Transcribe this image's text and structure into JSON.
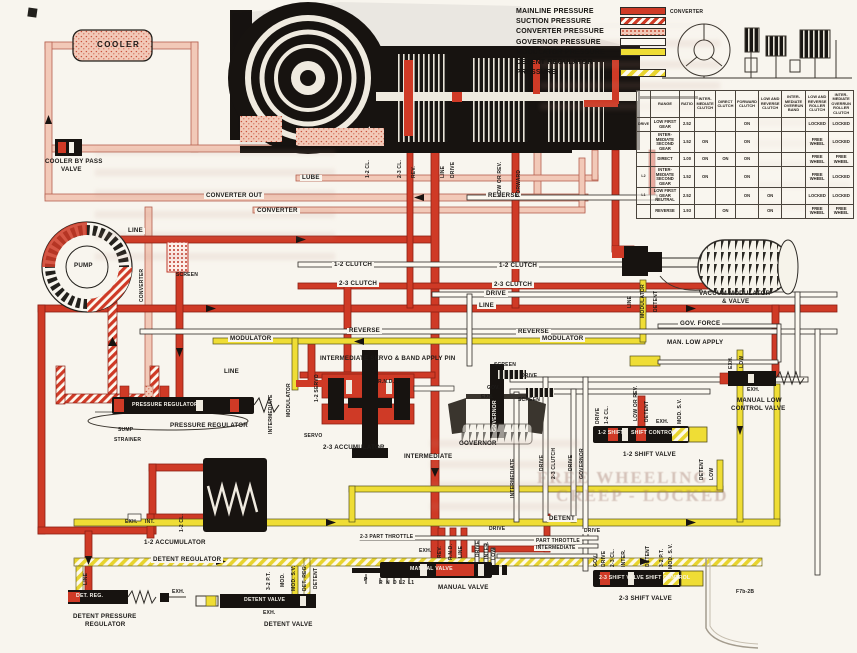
{
  "legend": {
    "items": [
      {
        "label": "MAINLINE PRESSURE",
        "swatch": "solid-red"
      },
      {
        "label": "SUCTION PRESSURE",
        "swatch": "hatch-red"
      },
      {
        "label": "CONVERTER PRESSURE",
        "swatch": "stipple-pink"
      },
      {
        "label": "GOVERNOR PRESSURE",
        "swatch": "white"
      },
      {
        "label": "MODULATOR PRESSURE",
        "swatch": "solid-yellow"
      },
      {
        "label": "DETENT REGULATOR",
        "swatch": "none"
      },
      {
        "label": "PRESSURE",
        "swatch": "hatch-yellow"
      }
    ]
  },
  "colors": {
    "mainline": "#cf3a26",
    "suction": "#cf3a26",
    "converter": "#f2c9b8",
    "governor": "#fcf9f1",
    "modulator": "#efdd35",
    "detent": "#e8d42e",
    "paper": "#f8f5ee"
  },
  "clutch_table": {
    "headers": [
      "",
      "RANGE",
      "RATIO",
      "INTER-MEDIATE CLUTCH",
      "DIRECT CLUTCH",
      "FORWARD CLUTCH",
      "LOW AND REVERSE CLUTCH",
      "INTER-MEDIATE OVERRUN BAND",
      "LOW AND REVERSE ROLLER CLUTCH",
      "INTER-MEDIATE OVERRUN ROLLER CLUTCH"
    ],
    "rows": [
      [
        "DRIVE",
        "LOW FIRST GEAR",
        "2.52",
        "",
        "",
        "ON",
        "",
        "",
        "LOCKED",
        "LOCKED"
      ],
      [
        "",
        "INTER-MEDIATE SECOND GEAR",
        "1.52",
        "ON",
        "",
        "ON",
        "",
        "",
        "FREE WHEEL",
        "LOCKED"
      ],
      [
        "",
        "DIRECT",
        "1.00",
        "ON",
        "ON",
        "ON",
        "",
        "",
        "FREE WHEEL",
        "FREE WHEEL"
      ],
      [
        "L2",
        "INTER-MEDIATE SECOND GEAR",
        "1.52",
        "ON",
        "",
        "ON",
        "",
        "",
        "FREE WHEEL",
        "LOCKED"
      ],
      [
        "L1",
        "LOW FIRST GEAR NEUTRAL",
        "2.52",
        "",
        "",
        "ON",
        "ON",
        "",
        "LOCKED",
        "LOCKED"
      ],
      [
        "",
        "REVERSE",
        "1.93",
        "",
        "ON",
        "",
        "ON",
        "",
        "FREE WHEEL",
        "FREE WHEEL"
      ]
    ]
  },
  "diagram": {
    "fig_number": "F7b-2B",
    "mini_schematic_label": "CONVERTER",
    "ghosts": [
      {
        "t": "FREE WHEELING",
        "x": 537,
        "y": 468,
        "s": 17
      },
      {
        "t": "CREEP - LOCKED",
        "x": 556,
        "y": 486,
        "s": 17
      }
    ],
    "labels": [
      {
        "t": "COOLER",
        "x": 97,
        "y": 41,
        "c": "b7"
      },
      {
        "t": "COOLER BY PASS",
        "x": 45,
        "y": 159
      },
      {
        "t": "VALVE",
        "x": 61,
        "y": 167
      },
      {
        "t": "CONVERTER OUT",
        "x": 204,
        "y": 193,
        "c": "in"
      },
      {
        "t": "CONVERTER",
        "x": 255,
        "y": 208,
        "c": "in"
      },
      {
        "t": "LUBE",
        "x": 300,
        "y": 175,
        "c": "in"
      },
      {
        "t": "REVERSE",
        "x": 486,
        "y": 193,
        "c": "in"
      },
      {
        "t": "LINE",
        "x": 126,
        "y": 228,
        "c": "in"
      },
      {
        "t": "SCREEN",
        "x": 176,
        "y": 273,
        "c": "b5"
      },
      {
        "t": "PUMP",
        "x": 74,
        "y": 263
      },
      {
        "t": "CONVERTER",
        "x": 140,
        "y": 302,
        "r": 1,
        "c": "b5"
      },
      {
        "t": "1-2 CL.",
        "x": 366,
        "y": 178,
        "r": 1,
        "c": "b5"
      },
      {
        "t": "2-3 CL.",
        "x": 398,
        "y": 178,
        "r": 1,
        "c": "b5"
      },
      {
        "t": "REV.",
        "x": 412,
        "y": 178,
        "r": 1,
        "c": "b5"
      },
      {
        "t": "LINE",
        "x": 441,
        "y": 178,
        "r": 1,
        "c": "b5"
      },
      {
        "t": "DRIVE",
        "x": 451,
        "y": 178,
        "r": 1,
        "c": "b5"
      },
      {
        "t": "LOW OR REV.",
        "x": 498,
        "y": 197,
        "r": 1,
        "c": "b5"
      },
      {
        "t": "FORWARD",
        "x": 517,
        "y": 197,
        "r": 1,
        "c": "b5"
      },
      {
        "t": "1-2 CLUTCH",
        "x": 332,
        "y": 262,
        "c": "in"
      },
      {
        "t": "1-2 CLUTCH",
        "x": 497,
        "y": 263,
        "c": "in"
      },
      {
        "t": "2-3 CLUTCH",
        "x": 337,
        "y": 281,
        "c": "in"
      },
      {
        "t": "2-3 CLUTCH",
        "x": 492,
        "y": 282,
        "c": "in"
      },
      {
        "t": "DRIVE",
        "x": 484,
        "y": 291,
        "c": "in"
      },
      {
        "t": "LINE",
        "x": 477,
        "y": 303,
        "c": "in"
      },
      {
        "t": "REVERSE",
        "x": 347,
        "y": 328,
        "c": "in"
      },
      {
        "t": "REVERSE",
        "x": 516,
        "y": 329,
        "c": "in"
      },
      {
        "t": "MODULATOR",
        "x": 540,
        "y": 336,
        "c": "in"
      },
      {
        "t": "MODULATOR",
        "x": 228,
        "y": 336,
        "c": "in"
      },
      {
        "t": "VACUUM MODULATOR",
        "x": 699,
        "y": 291
      },
      {
        "t": "& VALVE",
        "x": 722,
        "y": 299
      },
      {
        "t": "LINE",
        "x": 628,
        "y": 308,
        "r": 1,
        "c": "b5"
      },
      {
        "t": "MODULATOR",
        "x": 641,
        "y": 318,
        "r": 1,
        "c": "b5"
      },
      {
        "t": "DETENT",
        "x": 654,
        "y": 312,
        "r": 1,
        "c": "b5"
      },
      {
        "t": "GOV. FORCE",
        "x": 678,
        "y": 321,
        "c": "in"
      },
      {
        "t": "MAN. LOW APPLY",
        "x": 665,
        "y": 340,
        "c": "in"
      },
      {
        "t": "EXH.",
        "x": 729,
        "y": 369,
        "r": 1,
        "c": "b5"
      },
      {
        "t": "LOW",
        "x": 740,
        "y": 368,
        "r": 1,
        "c": "b5"
      },
      {
        "t": "EXH.",
        "x": 747,
        "y": 388,
        "c": "b5"
      },
      {
        "t": "MANUAL LOW",
        "x": 737,
        "y": 398
      },
      {
        "t": "CONTROL VALVE",
        "x": 731,
        "y": 406
      },
      {
        "t": "INTERMEDIATE SERVO & BAND APPLY PIN",
        "x": 320,
        "y": 356
      },
      {
        "t": "1-2 SERVO",
        "x": 315,
        "y": 402,
        "r": 1,
        "c": "b5"
      },
      {
        "t": "R.N.D.",
        "x": 378,
        "y": 380,
        "c": "b5"
      },
      {
        "t": "MODULATOR",
        "x": 287,
        "y": 417,
        "r": 1,
        "c": "b5"
      },
      {
        "t": "SERVO",
        "x": 304,
        "y": 434,
        "c": "b5"
      },
      {
        "t": "2-3 ACCUMULATOR",
        "x": 323,
        "y": 445
      },
      {
        "t": "INTERMEDIATE",
        "x": 402,
        "y": 454,
        "c": "in"
      },
      {
        "t": "PRESSURE REGULATOR",
        "x": 132,
        "y": 403,
        "c": "ov"
      },
      {
        "t": "PRESSURE REGULATOR",
        "x": 170,
        "y": 423
      },
      {
        "t": "LINE",
        "x": 222,
        "y": 369,
        "c": "in"
      },
      {
        "t": "SUMP",
        "x": 118,
        "y": 428,
        "c": "b5"
      },
      {
        "t": "STRAINER",
        "x": 114,
        "y": 438,
        "c": "b5"
      },
      {
        "t": "INTERMEDIATE",
        "x": 269,
        "y": 434,
        "r": 1,
        "c": "b5"
      },
      {
        "t": "SCREEN",
        "x": 494,
        "y": 363,
        "c": "b5"
      },
      {
        "t": "DRIVE",
        "x": 521,
        "y": 374,
        "c": "b5"
      },
      {
        "t": "GOV.",
        "x": 487,
        "y": 386,
        "c": "b5"
      },
      {
        "t": "EXH.",
        "x": 481,
        "y": 395,
        "c": "b5"
      },
      {
        "t": "SCREEN",
        "x": 518,
        "y": 398,
        "c": "b5"
      },
      {
        "t": "GOVERNOR",
        "x": 493,
        "y": 432,
        "r": 1,
        "c": "ov"
      },
      {
        "t": "GOVERNOR",
        "x": 459,
        "y": 441
      },
      {
        "t": "DRIVE",
        "x": 540,
        "y": 471,
        "r": 1,
        "c": "b5"
      },
      {
        "t": "2-3 CLUTCH",
        "x": 552,
        "y": 479,
        "r": 1,
        "c": "b5"
      },
      {
        "t": "DRIVE",
        "x": 569,
        "y": 471,
        "r": 1,
        "c": "b5"
      },
      {
        "t": "GOVERNOR",
        "x": 580,
        "y": 479,
        "r": 1,
        "c": "b5"
      },
      {
        "t": "INTERMEDIATE",
        "x": 511,
        "y": 498,
        "r": 1,
        "c": "b5"
      },
      {
        "t": "1-2 SHIFT",
        "x": 598,
        "y": 431,
        "c": "ov"
      },
      {
        "t": "SHIFT CONTROL",
        "x": 631,
        "y": 431,
        "c": "ov"
      },
      {
        "t": "1-2 SHIFT VALVE",
        "x": 623,
        "y": 452
      },
      {
        "t": "DRIVE",
        "x": 596,
        "y": 424,
        "r": 1,
        "c": "b5"
      },
      {
        "t": "1-2 CL.",
        "x": 605,
        "y": 424,
        "r": 1,
        "c": "b5"
      },
      {
        "t": "LOW OR REV.",
        "x": 634,
        "y": 421,
        "r": 1,
        "c": "b5"
      },
      {
        "t": "DETENT",
        "x": 645,
        "y": 422,
        "r": 1,
        "c": "b5"
      },
      {
        "t": "EXH.",
        "x": 656,
        "y": 420,
        "c": "b5"
      },
      {
        "t": "MOD. S.V.",
        "x": 678,
        "y": 424,
        "r": 1,
        "c": "b5"
      },
      {
        "t": "DETENT",
        "x": 700,
        "y": 480,
        "r": 1,
        "c": "b5"
      },
      {
        "t": "LOW",
        "x": 710,
        "y": 480,
        "r": 1,
        "c": "b5"
      },
      {
        "t": "EXH.",
        "x": 419,
        "y": 549,
        "c": "b5"
      },
      {
        "t": "REV.",
        "x": 438,
        "y": 558,
        "r": 1,
        "c": "b5"
      },
      {
        "t": "R.N.D.",
        "x": 449,
        "y": 560,
        "r": 1,
        "c": "b5"
      },
      {
        "t": "LINE",
        "x": 459,
        "y": 558,
        "r": 1,
        "c": "b5"
      },
      {
        "t": "MANUAL VALVE",
        "x": 410,
        "y": 567,
        "c": "ov"
      },
      {
        "t": "MANUAL VALVE",
        "x": 438,
        "y": 585
      },
      {
        "t": "DRIVE",
        "x": 476,
        "y": 557,
        "r": 1,
        "c": "b5"
      },
      {
        "t": "INTER.",
        "x": 485,
        "y": 559,
        "r": 1,
        "c": "b5"
      },
      {
        "t": "LOW",
        "x": 492,
        "y": 560,
        "r": 1,
        "c": "b5"
      },
      {
        "t": "P",
        "x": 364,
        "y": 578,
        "c": "b5"
      },
      {
        "t": "R",
        "x": 379,
        "y": 581,
        "c": "b5"
      },
      {
        "t": "N",
        "x": 386,
        "y": 581,
        "c": "b5"
      },
      {
        "t": "D",
        "x": 393,
        "y": 581,
        "c": "b5"
      },
      {
        "t": "L2",
        "x": 399,
        "y": 581,
        "c": "b5"
      },
      {
        "t": "L1",
        "x": 408,
        "y": 581,
        "c": "b5"
      },
      {
        "t": "EXH.",
        "x": 125,
        "y": 520,
        "c": "b5"
      },
      {
        "t": "INT.",
        "x": 145,
        "y": 520,
        "c": "b5"
      },
      {
        "t": "1-2 CL.",
        "x": 180,
        "y": 532,
        "r": 1,
        "c": "b5"
      },
      {
        "t": "1-2 ACCUMULATOR",
        "x": 144,
        "y": 540
      },
      {
        "t": "DETENT REGULATOR",
        "x": 151,
        "y": 557,
        "c": "in"
      },
      {
        "t": "DET. REG.",
        "x": 76,
        "y": 594,
        "c": "ov"
      },
      {
        "t": "EXH.",
        "x": 172,
        "y": 590,
        "c": "b5"
      },
      {
        "t": "LINE",
        "x": 84,
        "y": 585,
        "r": 1,
        "c": "b5"
      },
      {
        "t": "DETENT PRESSURE",
        "x": 73,
        "y": 614
      },
      {
        "t": "REGULATOR",
        "x": 85,
        "y": 622
      },
      {
        "t": "3-2 P.T.",
        "x": 267,
        "y": 590,
        "r": 1,
        "c": "b5"
      },
      {
        "t": "MOD.",
        "x": 281,
        "y": 587,
        "r": 1,
        "c": "b5"
      },
      {
        "t": "MOD. S.V.",
        "x": 292,
        "y": 591,
        "r": 1,
        "c": "b5"
      },
      {
        "t": "DET. REG.",
        "x": 303,
        "y": 591,
        "r": 1,
        "c": "b5"
      },
      {
        "t": "DETENT",
        "x": 314,
        "y": 589,
        "r": 1,
        "c": "b5"
      },
      {
        "t": "DETENT VALVE",
        "x": 244,
        "y": 598,
        "c": "ov"
      },
      {
        "t": "EXH.",
        "x": 263,
        "y": 611,
        "c": "b5"
      },
      {
        "t": "DETENT VALVE",
        "x": 264,
        "y": 622
      },
      {
        "t": "DETENT",
        "x": 547,
        "y": 516,
        "c": "in"
      },
      {
        "t": "DRIVE",
        "x": 487,
        "y": 527,
        "c": "b5 in"
      },
      {
        "t": "DRIVE",
        "x": 582,
        "y": 529,
        "c": "b5 in"
      },
      {
        "t": "PART THROTTLE",
        "x": 534,
        "y": 539,
        "c": "b5 in"
      },
      {
        "t": "INTERMEDIATE",
        "x": 534,
        "y": 546,
        "c": "b5 in"
      },
      {
        "t": "2-3 PART THROTTLE",
        "x": 358,
        "y": 535,
        "c": "b5 in"
      },
      {
        "t": "GOV.",
        "x": 594,
        "y": 567,
        "r": 1,
        "c": "b5"
      },
      {
        "t": "DRIVE",
        "x": 602,
        "y": 567,
        "r": 1,
        "c": "b5"
      },
      {
        "t": "2-3 CL.",
        "x": 611,
        "y": 567,
        "r": 1,
        "c": "b5"
      },
      {
        "t": "INTER.",
        "x": 622,
        "y": 567,
        "r": 1,
        "c": "b5"
      },
      {
        "t": "DETENT",
        "x": 646,
        "y": 567,
        "r": 1,
        "c": "b5"
      },
      {
        "t": "3-2 P.T.",
        "x": 660,
        "y": 567,
        "r": 1,
        "c": "b5"
      },
      {
        "t": "MOD. S.V.",
        "x": 669,
        "y": 569,
        "r": 1,
        "c": "b5"
      },
      {
        "t": "2-3 SHIFT VALVE  SHIFT CONTROL",
        "x": 599,
        "y": 576,
        "c": "ov"
      },
      {
        "t": "2-3 SHIFT VALVE",
        "x": 619,
        "y": 596
      },
      {
        "t": "CONVERTER",
        "x": 670,
        "y": 10,
        "c": "b5"
      },
      {
        "t": "F7b-2B",
        "x": 736,
        "y": 590,
        "c": "b5"
      }
    ]
  }
}
